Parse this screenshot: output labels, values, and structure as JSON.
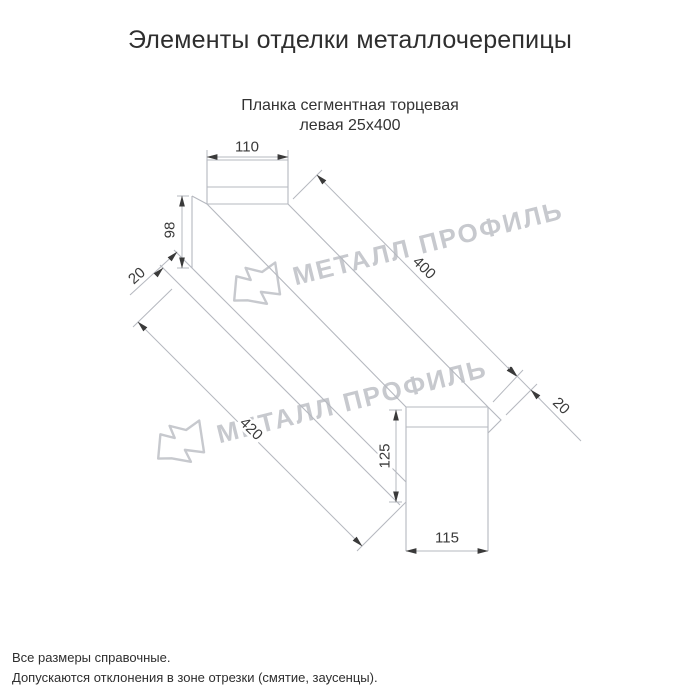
{
  "page": {
    "title": "Элементы отделки металлочерепицы"
  },
  "drawing": {
    "subtitle_line1": "Планка сегментная торцевая",
    "subtitle_line2": "левая 25х400",
    "dimensions": {
      "top_width": "110",
      "left_height": "98",
      "left_flange": "20",
      "length_top": "400",
      "right_flange": "20",
      "length_bottom": "420",
      "right_height": "125",
      "bottom_width": "115"
    },
    "colors": {
      "line": "#b5b8bf",
      "dim_text": "#3a3a3a",
      "watermark": "#c7c9ce"
    }
  },
  "watermark": {
    "text": "МЕТАЛЛ ПРОФИЛЬ"
  },
  "footer": {
    "line1": "Все размеры справочные.",
    "line2": "Допускаются отклонения в зоне отрезки (смятие, заусенцы)."
  }
}
